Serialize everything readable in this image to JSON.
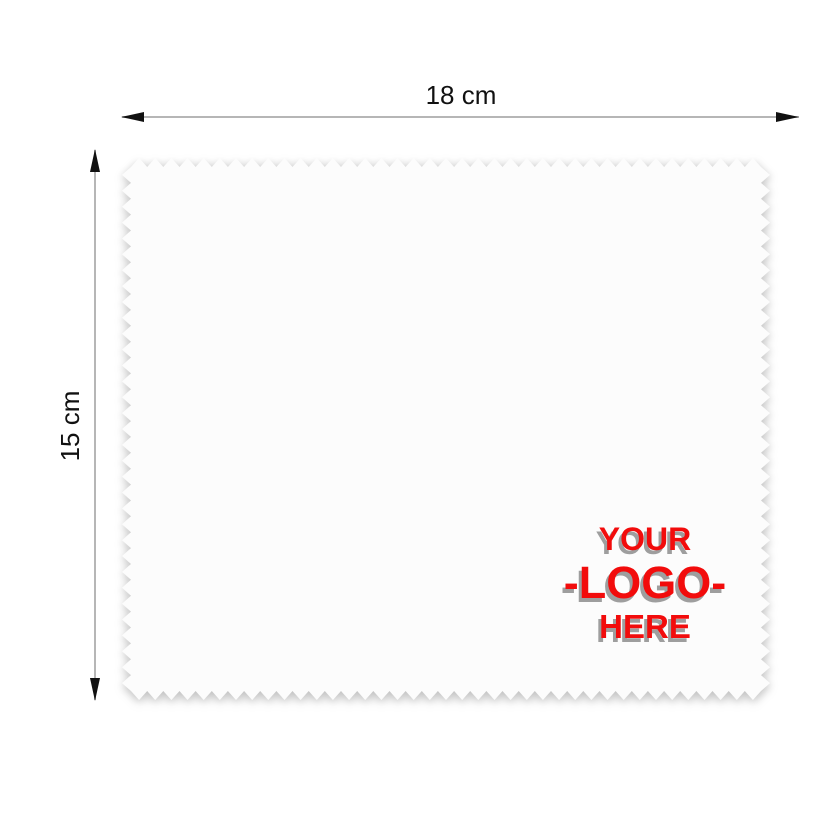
{
  "dimensions": {
    "width_label": "18 cm",
    "height_label": "15 cm"
  },
  "logo": {
    "line1": "YOUR",
    "line2": "-LOGO-",
    "line3": "HERE"
  },
  "colors": {
    "background": "#ffffff",
    "cloth_fill": "#fcfcfc",
    "dimension_line": "#b6b6b6",
    "arrowhead": "#111111",
    "label_text": "#111111",
    "logo_red": "#f20c0c",
    "logo_shadow": "#9e9e9e"
  }
}
